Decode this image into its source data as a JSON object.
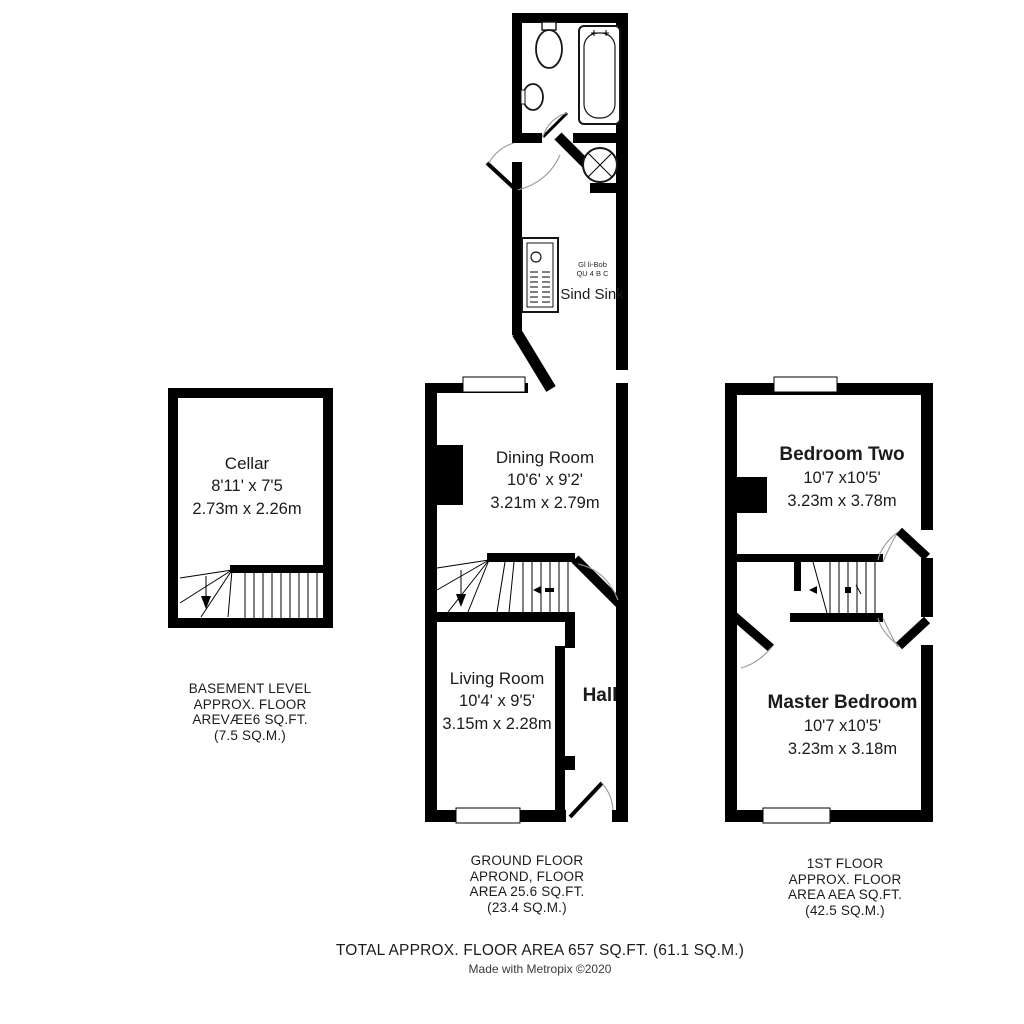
{
  "basement": {
    "room": {
      "name": "Cellar",
      "imperial": "8'11' x 7'5",
      "metric": "2.73m x 2.26m"
    },
    "caption": [
      "BASEMENT LEVEL",
      "APPROX. FLOOR",
      "AREVÆE6 SQ.FT.",
      "(7.5 SQ.M.)"
    ]
  },
  "ground": {
    "dining_room": {
      "name": "Dining Room",
      "imperial": "10'6' x 9'2'",
      "metric": "3.21m x 2.79m"
    },
    "living_room": {
      "name": "Living Room",
      "imperial": "10'4' x 9'5'",
      "metric": "3.15m x 2.28m"
    },
    "hall": {
      "name": "Hall"
    },
    "kitchen": {
      "note_line1": "Gl li-Bob",
      "note_line2": "QU 4 B C",
      "sink_label": "Sind Sink"
    },
    "caption": [
      "GROUND FLOOR",
      "APROND, FLOOR",
      "AREA 25.6 SQ.FT.",
      "(23.4 SQ.M.)"
    ]
  },
  "first_floor": {
    "bedroom_two": {
      "name": "Bedroom Two",
      "imperial": "10'7 x10'5'",
      "metric": "3.23m x 3.78m"
    },
    "master_bedroom": {
      "name": "Master Bedroom",
      "imperial": "10'7 x10'5'",
      "metric": "3.23m x 3.18m"
    },
    "caption": [
      "1ST FLOOR",
      "APPROX. FLOOR",
      "AREA AEA SQ.FT.",
      "(42.5 SQ.M.)"
    ]
  },
  "footer": {
    "total": "TOTAL APPROX. FLOOR AREA 657 SQ.FT. (61.1 SQ.M.)",
    "credit": "Made with Metropix ©2020"
  }
}
